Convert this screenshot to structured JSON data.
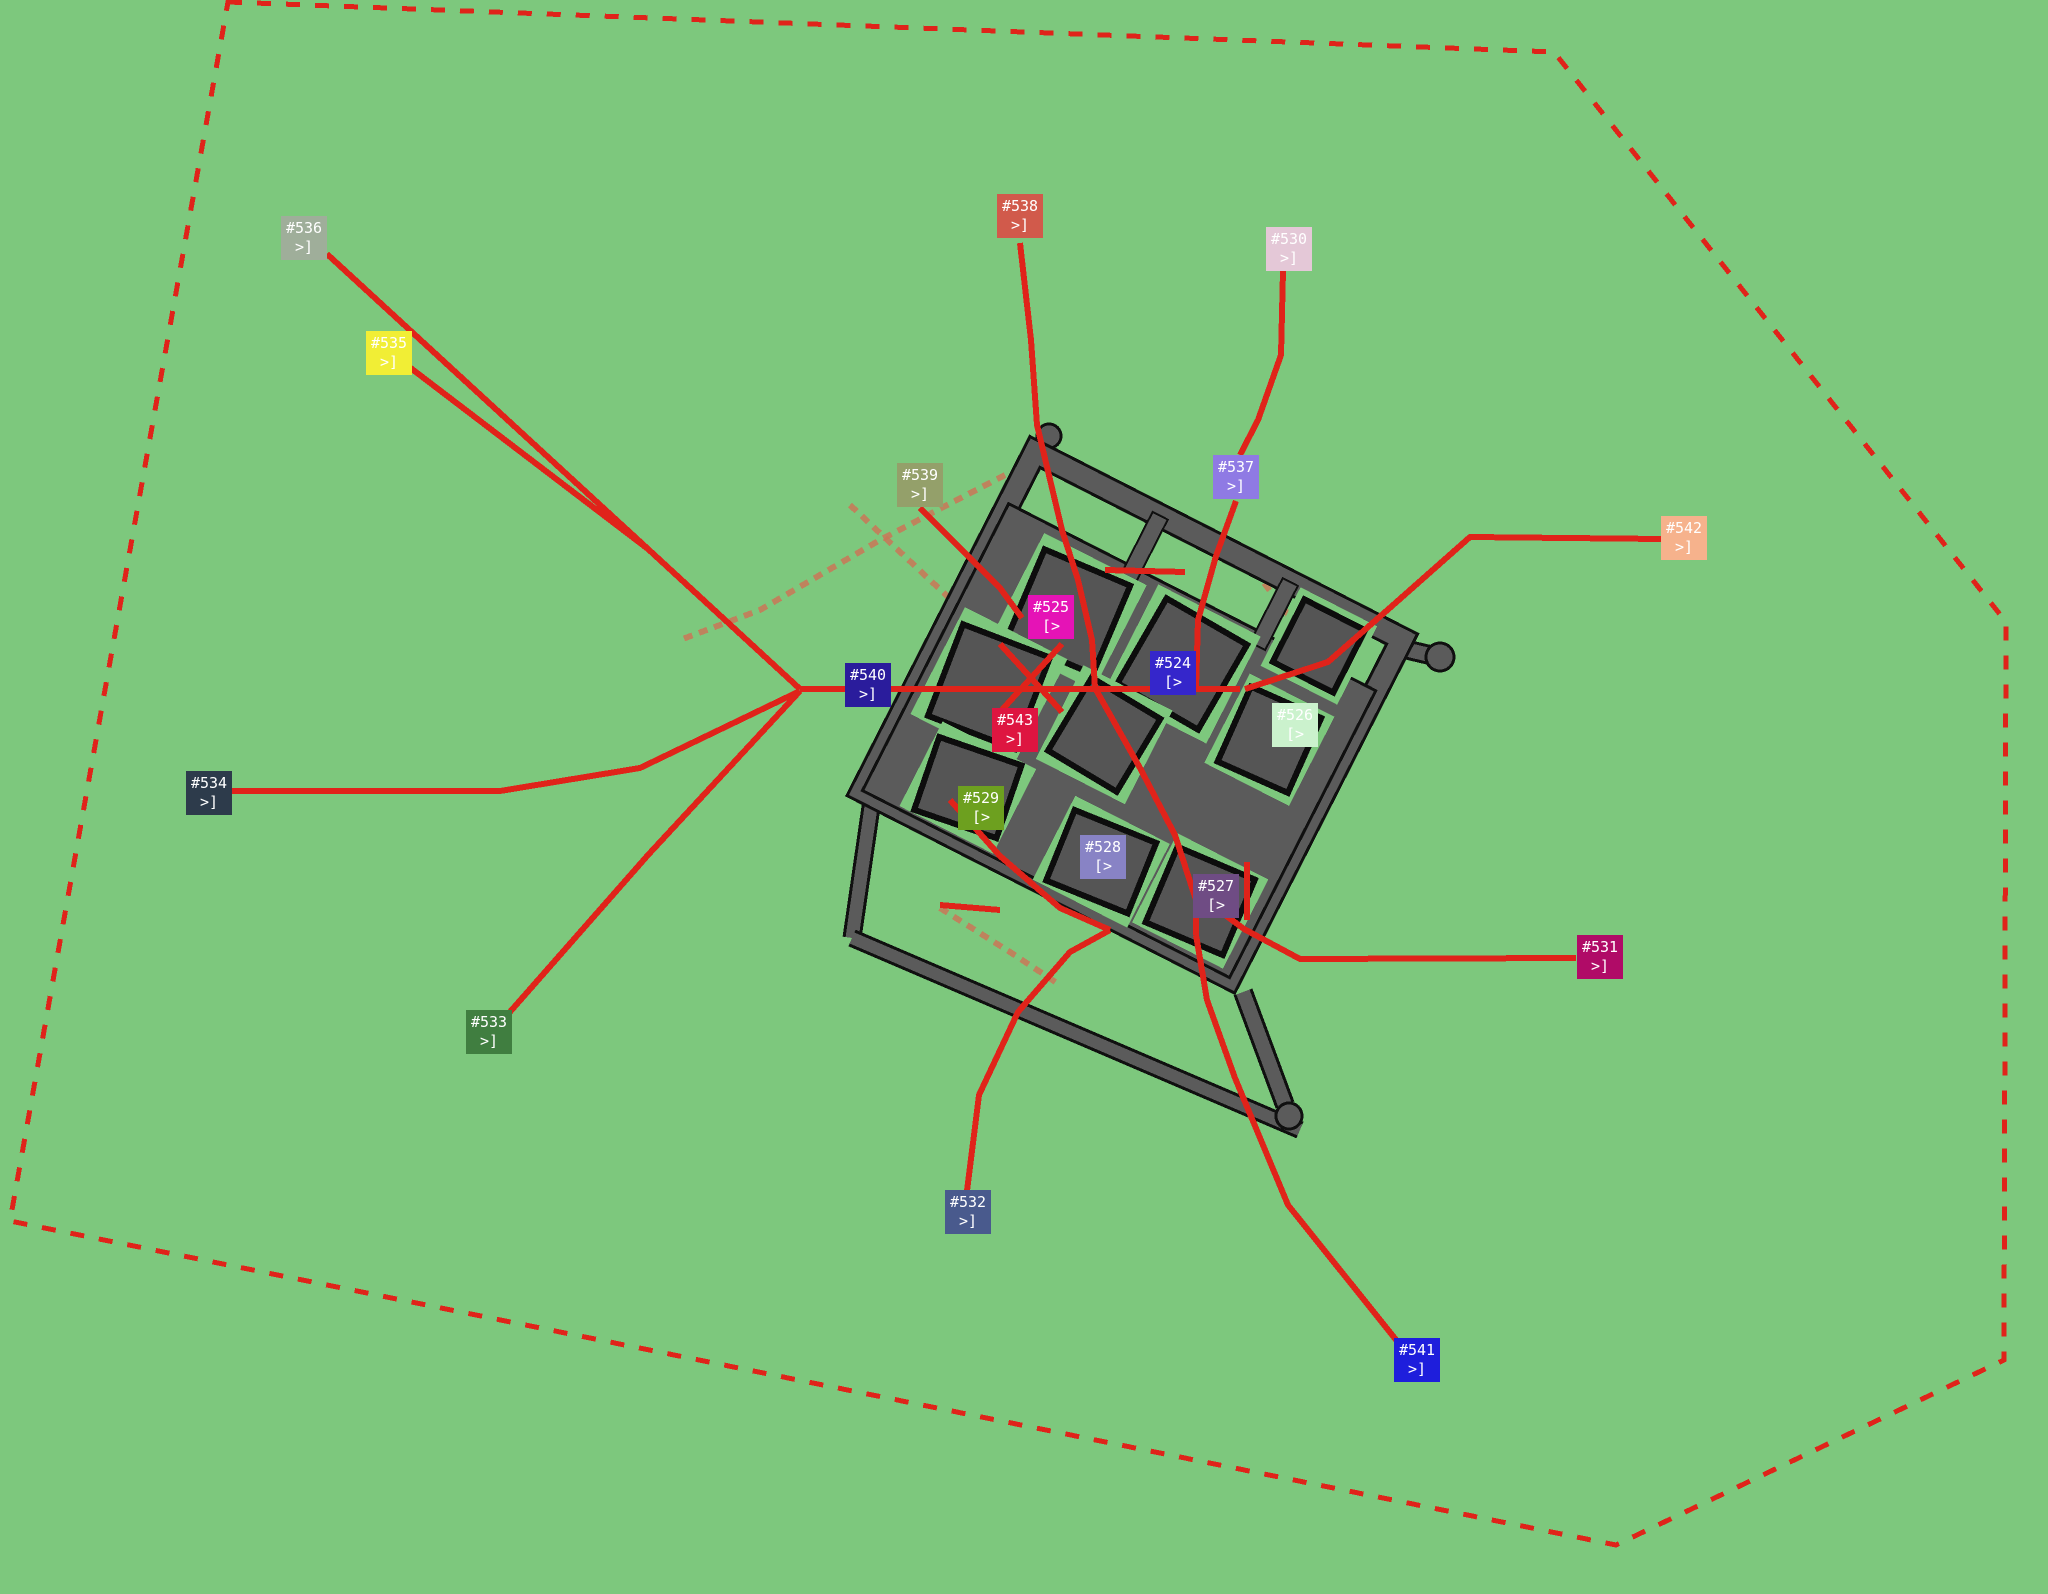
{
  "scene": {
    "background_color": "#7dc87d",
    "boundary_color": "#e0231a",
    "route_color": "#e0231a",
    "faded_route_color": "#c97757",
    "road_fill": "#5b5b5b",
    "road_edge": "#101010",
    "building_fill": "#555555",
    "building_edge": "#0d0d0d",
    "marker_text_color": "#ffffff"
  },
  "boundary": {
    "points": "228,2 1554,52 2006,622 2004,1360 1616,1545 10,1221"
  },
  "compound": {
    "translate": [
      1035,
      452
    ],
    "rotate": 27,
    "wall": {
      "x": 0,
      "y": 0,
      "w": 412,
      "h": 380
    },
    "paved": {
      "x": 0,
      "y": 58,
      "w": 412,
      "h": 322
    },
    "connectors": [
      {
        "x": 132,
        "y": 0,
        "w": 17,
        "h": 72
      },
      {
        "x": 278,
        "y": 0,
        "w": 17,
        "h": 72
      }
    ],
    "blocks": [
      {
        "name": "block-525",
        "halo": [
          45,
          68,
          115,
          118
        ],
        "bldg": [
          56,
          79,
          93,
          96
        ],
        "tilt": -4
      },
      {
        "name": "block-524",
        "halo": [
          170,
          62,
          115,
          120
        ],
        "bldg": [
          181,
          73,
          93,
          98
        ],
        "tilt": 3
      },
      {
        "name": "block-northeast",
        "halo": [
          298,
          0,
          86,
          88
        ],
        "bldg": [
          307,
          9,
          68,
          70
        ],
        "tilt": 0
      },
      {
        "name": "block-526",
        "halo": [
          292,
          100,
          95,
          100
        ],
        "bldg": [
          301,
          109,
          77,
          82
        ],
        "tilt": -3
      },
      {
        "name": "block-543",
        "halo": [
          8,
          170,
          115,
          120
        ],
        "bldg": [
          19,
          181,
          93,
          98
        ],
        "tilt": -6
      },
      {
        "name": "block-center",
        "halo": [
          140,
          168,
          100,
          105
        ],
        "bldg": [
          150,
          178,
          80,
          85
        ],
        "tilt": 4
      },
      {
        "name": "block-529",
        "halo": [
          40,
          282,
          105,
          95
        ],
        "bldg": [
          49,
          291,
          87,
          77
        ],
        "tilt": -8
      },
      {
        "name": "block-528",
        "halo": [
          192,
          288,
          106,
          94
        ],
        "bldg": [
          201,
          297,
          88,
          76
        ],
        "tilt": -5
      },
      {
        "name": "block-527",
        "halo": [
          300,
          275,
          102,
          100
        ],
        "bldg": [
          309,
          284,
          84,
          82
        ],
        "tilt": -4
      }
    ]
  },
  "outworks": {
    "bars": [
      {
        "x1": 872,
        "y1": 800,
        "x2": 852,
        "y2": 938,
        "w": 13
      },
      {
        "x1": 852,
        "y1": 938,
        "x2": 1300,
        "y2": 1130,
        "w": 12
      },
      {
        "x1": 1243,
        "y1": 992,
        "x2": 1285,
        "y2": 1105,
        "w": 14
      },
      {
        "x1": 1040,
        "y1": 460,
        "x2": 1049,
        "y2": 438,
        "w": 12
      },
      {
        "x1": 1400,
        "y1": 648,
        "x2": 1434,
        "y2": 656,
        "w": 14
      }
    ],
    "knobs": [
      {
        "cx": 1289,
        "cy": 1116,
        "r": 13
      },
      {
        "cx": 1440,
        "cy": 657,
        "r": 14
      },
      {
        "cx": 1049,
        "cy": 436,
        "r": 12
      }
    ]
  },
  "routes": [
    {
      "name": "route-536",
      "points": "327,254 648,549 800,689"
    },
    {
      "name": "route-535",
      "points": "408,366 648,549"
    },
    {
      "name": "route-534",
      "points": "232,791 500,791 640,768 800,691"
    },
    {
      "name": "route-533",
      "points": "509,1013 648,855 800,691"
    },
    {
      "name": "route-540",
      "points": "800,689 1240,689"
    },
    {
      "name": "route-538",
      "points": "1020,243 1031,340 1037,425 1062,530 1078,580 1092,640 1095,688"
    },
    {
      "name": "route-530",
      "points": "1283,271 1281,355 1258,420 1240,455"
    },
    {
      "name": "route-537",
      "points": "1236,501 1216,556 1198,620 1196,688"
    },
    {
      "name": "route-542",
      "points": "1661,539 1470,537 1392,606 1328,662 1245,689"
    },
    {
      "name": "route-539",
      "points": "920,508 1000,588 1022,618"
    },
    {
      "name": "route-531",
      "points": "1576,958 1300,959 1244,929 1205,900"
    },
    {
      "name": "route-541",
      "points": "1397,1341 1288,1205 1235,1078 1207,1000 1196,935"
    },
    {
      "name": "route-532",
      "points": "967,1191 979,1095 1018,1012 1070,952 1110,930"
    },
    {
      "name": "route-inner-south",
      "points": "1095,688 1140,768 1175,835 1196,900 1196,935"
    },
    {
      "name": "route-inner-x1",
      "points": "1000,644 1062,712"
    },
    {
      "name": "route-inner-x2",
      "points": "1062,644 1000,712"
    },
    {
      "name": "route-inner-sw",
      "points": "950,800 1000,856 1060,908 1110,930"
    },
    {
      "name": "route-inner-527",
      "points": "1247,862 1247,920"
    },
    {
      "name": "route-inner-band",
      "points": "1105,570 1185,572"
    },
    {
      "name": "route-inner-529",
      "points": "940,905 1000,910"
    }
  ],
  "faded_routes": [
    {
      "name": "trail-northwest",
      "points": "1005,475 880,540 760,610 680,640"
    },
    {
      "name": "trail-center",
      "points": "850,505 930,580 1010,655 1060,695"
    },
    {
      "name": "trail-east",
      "points": "1235,545 1300,630"
    },
    {
      "name": "trail-south",
      "points": "940,908 1010,952 1060,985"
    }
  ],
  "markers": [
    {
      "id": "#536",
      "arrow": ">]",
      "x": 281,
      "y": 216,
      "color": "#9fae9a"
    },
    {
      "id": "#535",
      "arrow": ">]",
      "x": 366,
      "y": 331,
      "color": "#f1ee35"
    },
    {
      "id": "#538",
      "arrow": ">]",
      "x": 997,
      "y": 194,
      "color": "#d15a4b"
    },
    {
      "id": "#530",
      "arrow": ">]",
      "x": 1266,
      "y": 227,
      "color": "#e4c8d7"
    },
    {
      "id": "#537",
      "arrow": ">]",
      "x": 1213,
      "y": 455,
      "color": "#8f7ae4"
    },
    {
      "id": "#539",
      "arrow": ">]",
      "x": 897,
      "y": 463,
      "color": "#94a06a"
    },
    {
      "id": "#542",
      "arrow": ">]",
      "x": 1661,
      "y": 516,
      "color": "#f6b28c"
    },
    {
      "id": "#525",
      "arrow": "[>",
      "x": 1028,
      "y": 595,
      "color": "#e513b6"
    },
    {
      "id": "#524",
      "arrow": "[>",
      "x": 1150,
      "y": 651,
      "color": "#3526cb"
    },
    {
      "id": "#526",
      "arrow": "[>",
      "x": 1272,
      "y": 703,
      "color": "#cbf2cd"
    },
    {
      "id": "#540",
      "arrow": ">]",
      "x": 845,
      "y": 663,
      "color": "#2a1c9c"
    },
    {
      "id": "#543",
      "arrow": ">]",
      "x": 992,
      "y": 708,
      "color": "#de1540"
    },
    {
      "id": "#534",
      "arrow": ">]",
      "x": 186,
      "y": 771,
      "color": "#2d3b4b"
    },
    {
      "id": "#529",
      "arrow": "[>",
      "x": 958,
      "y": 786,
      "color": "#6da01f"
    },
    {
      "id": "#528",
      "arrow": "[>",
      "x": 1080,
      "y": 835,
      "color": "#8883c5"
    },
    {
      "id": "#527",
      "arrow": "[>",
      "x": 1193,
      "y": 874,
      "color": "#6f4c84"
    },
    {
      "id": "#531",
      "arrow": ">]",
      "x": 1577,
      "y": 935,
      "color": "#b00b67"
    },
    {
      "id": "#533",
      "arrow": ">]",
      "x": 466,
      "y": 1010,
      "color": "#407e40"
    },
    {
      "id": "#532",
      "arrow": ">]",
      "x": 945,
      "y": 1190,
      "color": "#495a8d"
    },
    {
      "id": "#541",
      "arrow": ">]",
      "x": 1394,
      "y": 1338,
      "color": "#1e1edc"
    }
  ]
}
